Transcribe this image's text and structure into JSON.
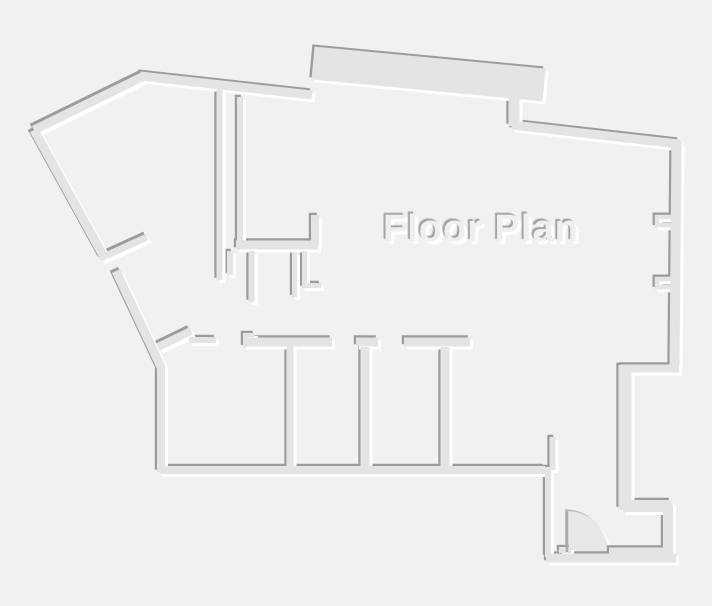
{
  "title": {
    "text": "Floor Plan"
  },
  "colors": {
    "background": "#f0f1f1",
    "wall_fill": "#e3e5e5",
    "wall_shadow": "#9c9c9c",
    "wall_highlight": "#ffffff",
    "door_fill": "#e7e9e9",
    "door_shadow": "#b4b7b7",
    "door_highlight": "#ffffff",
    "door_leaf": "#a9acac",
    "title_color": "#eef0f0"
  },
  "floorplan": {
    "canvas": {
      "width": 712,
      "height": 606
    },
    "walls": [
      {
        "d": "M34 130 L142 77",
        "w": 9
      },
      {
        "d": "M140 76 L312 95",
        "w": 9
      },
      {
        "d": "M313 63 L544 85",
        "w": 33
      },
      {
        "d": "M514 97 L514 126",
        "w": 11
      },
      {
        "d": "M512 125 L679 144",
        "w": 9
      },
      {
        "d": "M676.5 142 L674.5 366",
        "w": 10
      },
      {
        "d": "M679 368.5 L621 368.5",
        "w": 8
      },
      {
        "d": "M625 365 L625 509",
        "w": 13
      },
      {
        "d": "M623 506 L671 506",
        "w": 12
      },
      {
        "d": "M668 503 L668 557",
        "w": 10
      },
      {
        "d": "M676 558 L546 558",
        "w": 9
      },
      {
        "d": "M664 551 L609 551",
        "w": 7
      },
      {
        "d": "M548 557 L548 467",
        "w": 6
      },
      {
        "d": "M552.5 470 L552.5 437",
        "w": 6
      },
      {
        "d": "M545 470 L160 470",
        "w": 8
      },
      {
        "d": "M161 472 L161 364",
        "w": 8
      },
      {
        "d": "M116 271 L161 367",
        "w": 9
      },
      {
        "d": "M34 130 L104 257",
        "w": 9
      },
      {
        "d": "M101 258 L147 237",
        "w": 7
      },
      {
        "d": "M158 347 L191 331",
        "w": 8
      },
      {
        "d": "M189 340 L216 340",
        "w": 6
      },
      {
        "d": "M245 347 L245 335 L255 335",
        "w": 4
      },
      {
        "d": "M244 342 L332 342",
        "w": 9
      },
      {
        "d": "M290 346 L290 468",
        "w": 7
      },
      {
        "d": "M356 342 L378 342",
        "w": 9
      },
      {
        "d": "M365 347 L365 468",
        "w": 9
      },
      {
        "d": "M404 342 L470 342",
        "w": 9
      },
      {
        "d": "M445 347 L445 468",
        "w": 9
      },
      {
        "d": "M219.5 88 L219.5 280",
        "w": 6
      },
      {
        "d": "M240 97 L240 247",
        "w": 6
      },
      {
        "d": "M236 245 L318 245",
        "w": 9
      },
      {
        "d": "M315 245 L315 215",
        "w": 8
      },
      {
        "d": "M230 251 L230 275",
        "w": 6
      },
      {
        "d": "M251.5 251 L251.5 302",
        "w": 6
      },
      {
        "d": "M294.5 252 L294.5 297",
        "w": 5
      },
      {
        "d": "M304.5 251 L304.5 285.5 L321 285.5",
        "w": 5
      },
      {
        "d": "M672 217 L657 217 L657 225 L672 225",
        "w": 4.5
      },
      {
        "d": "M672 279 L657 279 L657 287 L672 287",
        "w": 4.5
      },
      {
        "d": "M559 550 L571 550",
        "w": 6
      }
    ],
    "door": {
      "disc": "M567 552 L567 511 A41 41 0 0 1 608 552 Z",
      "leaf": "M567 552 L567 511"
    }
  }
}
